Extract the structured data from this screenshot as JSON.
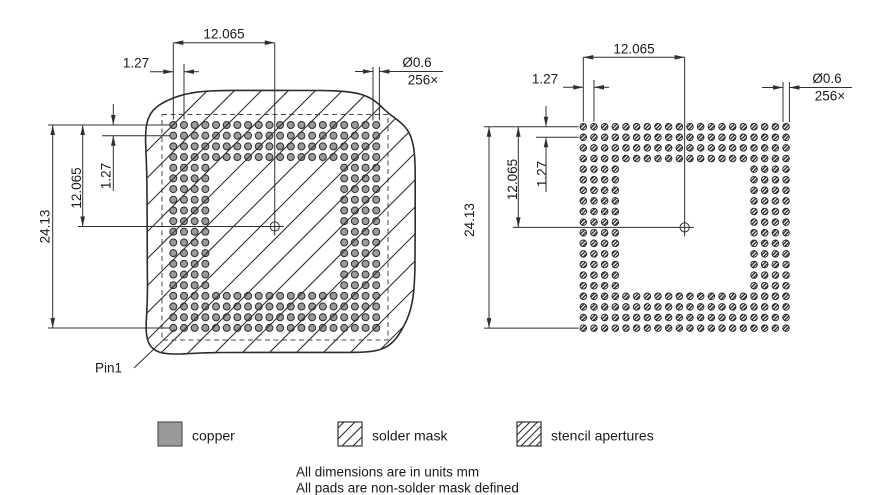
{
  "dims": {
    "span_half": "12.065",
    "pitch": "1.27",
    "span_full": "24.13",
    "pad_diameter": "Ø0.6",
    "pad_count": "256×"
  },
  "pin1_label": "Pin1",
  "legend": {
    "items": [
      {
        "id": "copper",
        "label": "copper"
      },
      {
        "id": "solder-mask",
        "label": "solder mask"
      },
      {
        "id": "stencil-apertures",
        "label": "stencil apertures"
      }
    ]
  },
  "notes": [
    "All dimensions are in units mm",
    "All pads are non-solder mask defined"
  ],
  "grid": {
    "rows": 20,
    "cols": 20,
    "perimeter_depth": 4,
    "pad_total": 256,
    "pitch_mm": 1.27,
    "pad_diameter_mm": 0.6,
    "span_mm": 24.13,
    "half_span_mm": 12.065
  },
  "colors": {
    "line": "#2f2f2f",
    "pad_fill": "#9a9a9a",
    "pad_stroke": "#2d2d2d",
    "copper_swatch": "#999999",
    "swatch_border": "#555555",
    "dash": "#4a4a4a",
    "text": "#1a1a1a"
  }
}
